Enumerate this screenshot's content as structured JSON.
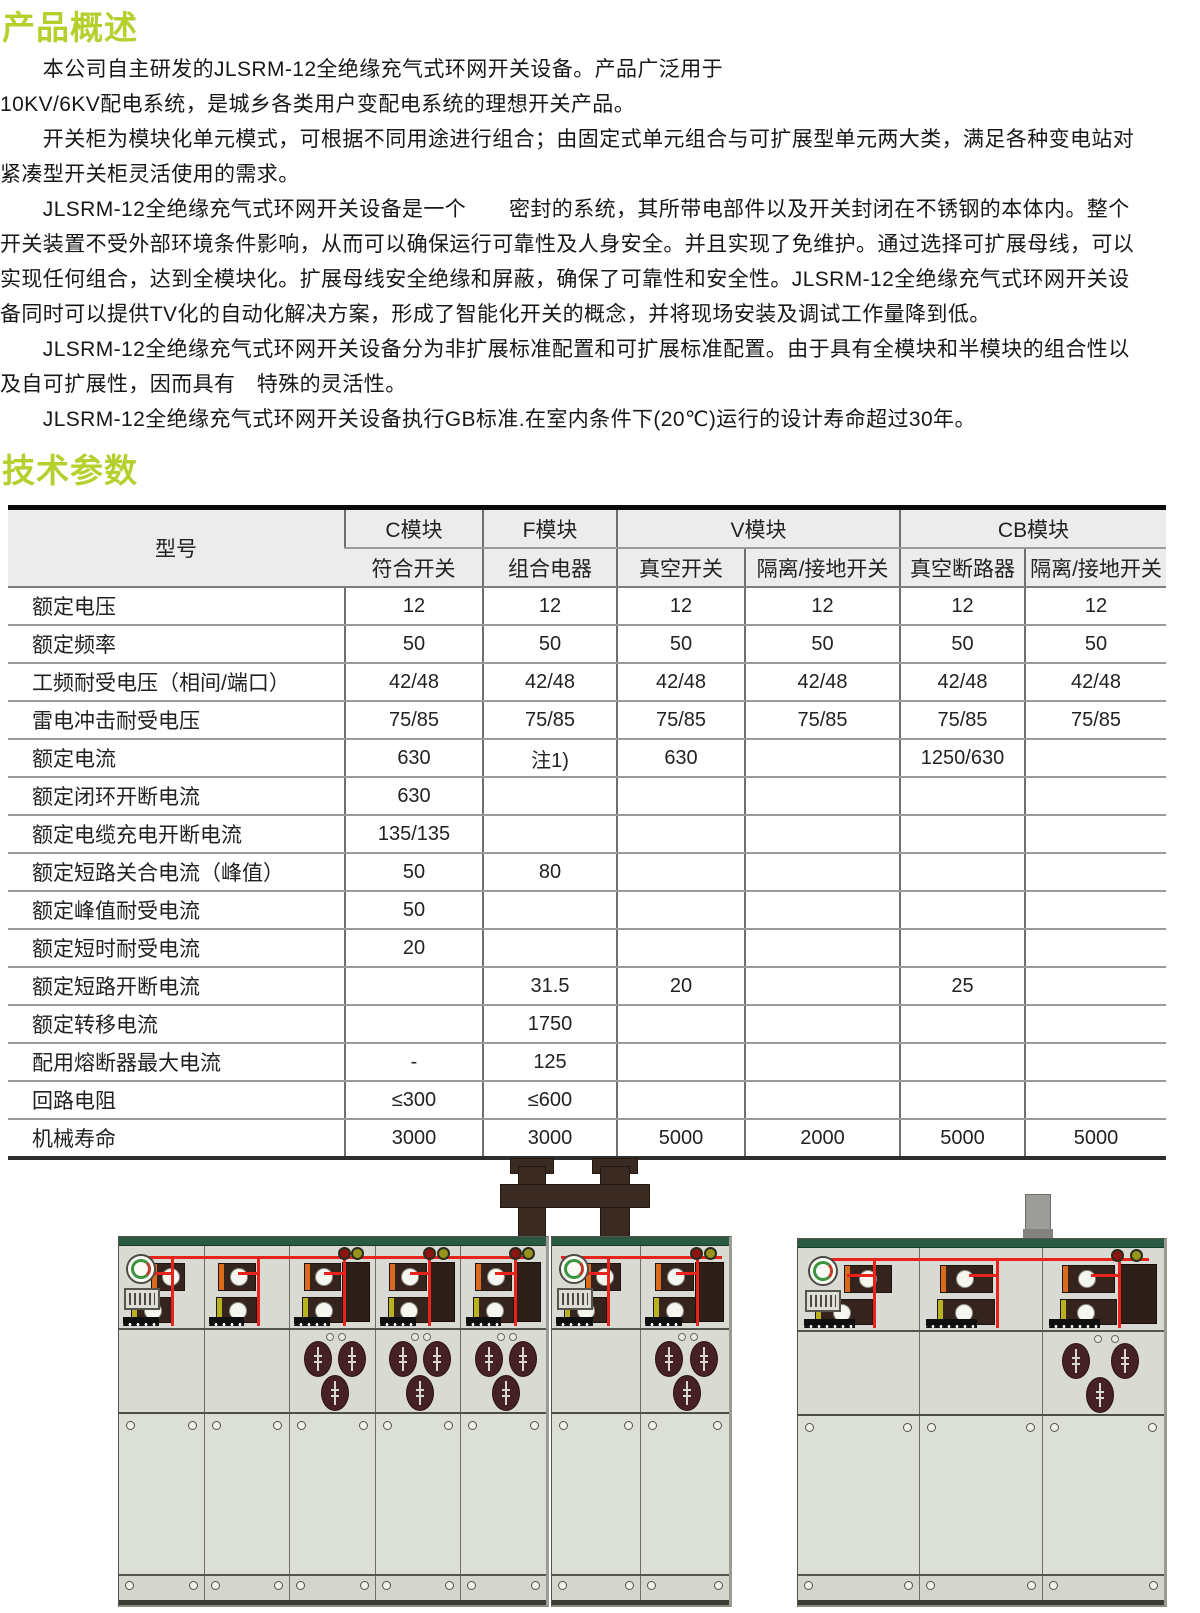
{
  "page": {
    "overview_heading": "产品概述",
    "params_heading": "技术参数"
  },
  "overview": {
    "lines": [
      "　　本公司自主研发的JLSRM-12全绝缘充气式环网开关设备。产品广泛用于",
      "10KV/6KV配电系统，是城乡各类用户变配电系统的理想开关产品。",
      "　　开关柜为模块化单元模式，可根据不同用途进行组合；由固定式单元组合与可扩展型单元两大类，满足各种变电站对",
      "紧凑型开关柜灵活使用的需求。",
      "　　JLSRM-12全绝缘充气式环网开关设备是一个　　密封的系统，其所带电部件以及开关封闭在不锈钢的本体内。整个",
      "开关装置不受外部环境条件影响，从而可以确保运行可靠性及人身安全。并且实现了免维护。通过选择可扩展母线，可以",
      "实现任何组合，达到全模块化。扩展母线安全绝缘和屏蔽，确保了可靠性和安全性。JLSRM-12全绝缘充气式环网开关设",
      "备同时可以提供TV化的自动化解决方案，形成了智能化开关的概念，并将现场安装及调试工作量降到低。",
      "　　JLSRM-12全绝缘充气式环网开关设备分为非扩展标准配置和可扩展标准配置。由于具有全模块和半模块的组合性以",
      "及自可扩展性，因而具有　特殊的灵活性。",
      "　　JLSRM-12全绝缘充气式环网开关设备执行GB标准.在室内条件下(20℃)运行的设计寿命超过30年。"
    ]
  },
  "table": {
    "model_label": "型号",
    "groups": [
      {
        "label": "C模块",
        "cols": [
          "符合开关"
        ]
      },
      {
        "label": "F模块",
        "cols": [
          "组合电器"
        ]
      },
      {
        "label": "V模块",
        "cols": [
          "真空开关",
          "隔离/接地开关"
        ]
      },
      {
        "label": "CB模块",
        "cols": [
          "真空断路器",
          "隔离/接地开关"
        ]
      }
    ],
    "rows": [
      {
        "label": "额定电压",
        "values": [
          "12",
          "12",
          "12",
          "12",
          "12",
          "12"
        ]
      },
      {
        "label": "额定频率",
        "values": [
          "50",
          "50",
          "50",
          "50",
          "50",
          "50"
        ]
      },
      {
        "label": "工频耐受电压（相间/端口）",
        "values": [
          "42/48",
          "42/48",
          "42/48",
          "42/48",
          "42/48",
          "42/48"
        ]
      },
      {
        "label": "雷电冲击耐受电压",
        "values": [
          "75/85",
          "75/85",
          "75/85",
          "75/85",
          "75/85",
          "75/85"
        ]
      },
      {
        "label": "额定电流",
        "values": [
          "630",
          "注1)",
          "630",
          "",
          "1250/630",
          ""
        ]
      },
      {
        "label": "额定闭环开断电流",
        "values": [
          "630",
          "",
          "",
          "",
          "",
          ""
        ]
      },
      {
        "label": "额定电缆充电开断电流",
        "values": [
          "135/135",
          "",
          "",
          "",
          "",
          ""
        ]
      },
      {
        "label": "额定短路关合电流（峰值）",
        "values": [
          "50",
          "80",
          "",
          "",
          "",
          ""
        ]
      },
      {
        "label": "额定峰值耐受电流",
        "values": [
          "50",
          "",
          "",
          "",
          "",
          ""
        ]
      },
      {
        "label": "额定短时耐受电流",
        "values": [
          "20",
          "",
          "",
          "",
          "",
          ""
        ]
      },
      {
        "label": "额定短路开断电流",
        "values": [
          "",
          "31.5",
          "20",
          "",
          "25",
          ""
        ]
      },
      {
        "label": "额定转移电流",
        "values": [
          "",
          "1750",
          "",
          "",
          "",
          ""
        ]
      },
      {
        "label": "配用熔断器最大电流",
        "values": [
          "-",
          "125",
          "",
          "",
          "",
          ""
        ]
      },
      {
        "label": "回路电阻",
        "values": [
          "≤300",
          "≤600",
          "",
          "",
          "",
          ""
        ]
      },
      {
        "label": "机械寿命",
        "values": [
          "3000",
          "3000",
          "5000",
          "2000",
          "5000",
          "5000"
        ]
      }
    ]
  },
  "figures": {
    "cabinets": [
      {
        "x": 118,
        "y": 76,
        "w": 427,
        "h": 368,
        "panels": [
          "c-logo",
          "c",
          "f",
          "f",
          "f"
        ]
      },
      {
        "x": 551,
        "y": 76,
        "w": 177,
        "h": 368,
        "panels": [
          "c-logo",
          "f"
        ]
      },
      {
        "x": 797,
        "y": 78,
        "w": 366,
        "h": 366,
        "panels": [
          "c-logo",
          "c",
          "f"
        ]
      }
    ]
  }
}
